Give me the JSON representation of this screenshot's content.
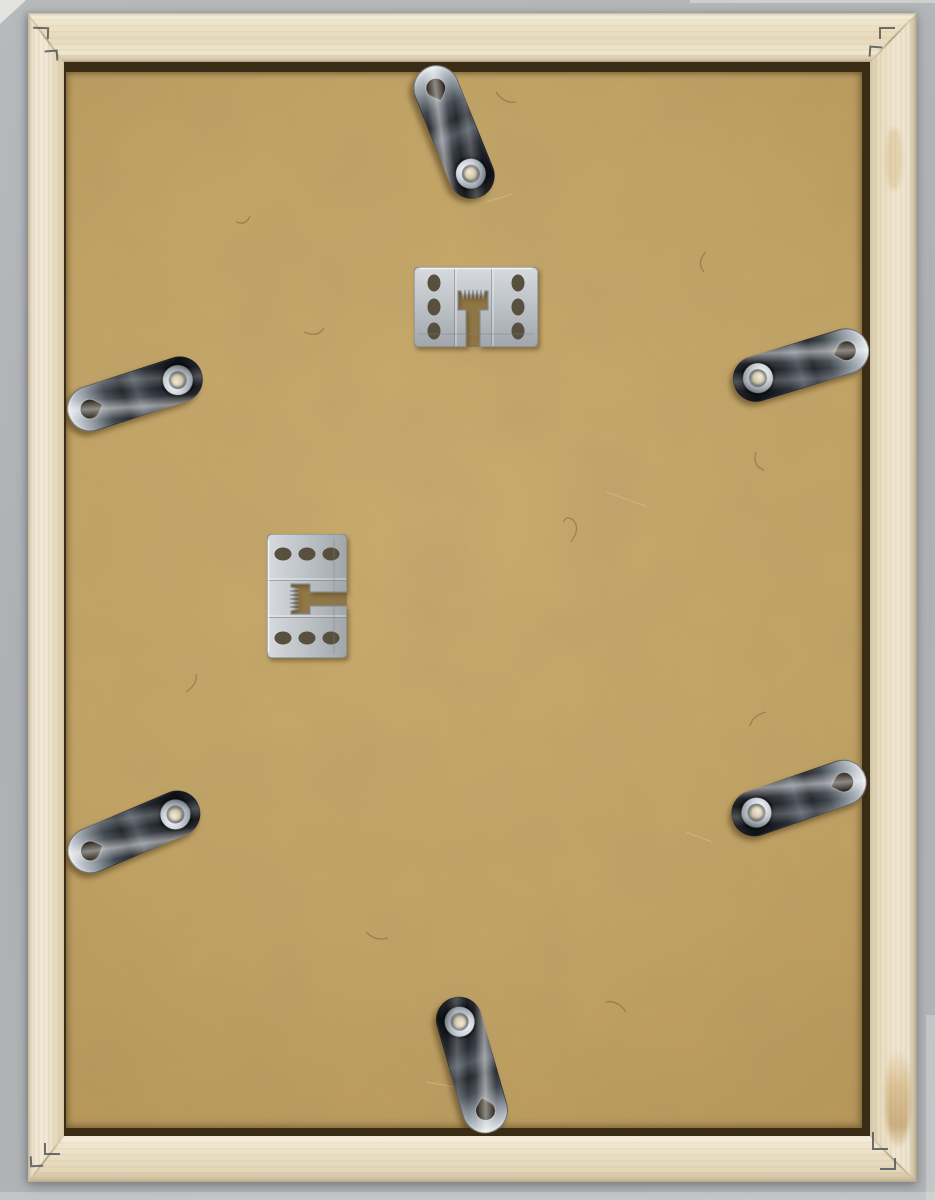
{
  "scene": {
    "type": "photograph",
    "subject": "Back side of an empty wooden picture frame lying on a gray surface",
    "background_surface": "plain light-gray textured backdrop",
    "frame": {
      "material": "natural pine wood",
      "corner_joinery": "mitered corners fastened with v-nails",
      "v_nail_marks_per_corner": 2,
      "glue_stain_location": "right rail near bottom corner"
    },
    "backing_board": {
      "material": "MDF hardboard",
      "color_hex": "#bfa162",
      "texture": "speckled fibers with light scratches"
    },
    "hardware": {
      "flexi_tabs": {
        "count": 6,
        "finish": "polished chrome steel",
        "features": [
          "teardrop keyhole at rim end",
          "screw with washer at inner end"
        ],
        "items": [
          {
            "id": "top-center",
            "x": 390,
            "y": 69.5,
            "rotation_deg": -22
          },
          {
            "id": "left-upper",
            "x": 70.5,
            "y": 331.5,
            "rotation_deg": -108
          },
          {
            "id": "right-upper",
            "x": 736.5,
            "y": 303,
            "rotation_deg": 73
          },
          {
            "id": "left-lower",
            "x": 70,
            "y": 769.5,
            "rotation_deg": -113
          },
          {
            "id": "right-lower",
            "x": 734.5,
            "y": 735.5,
            "rotation_deg": 71
          },
          {
            "id": "bottom-center",
            "x": 408,
            "y": 1003,
            "rotation_deg": 164
          }
        ]
      },
      "sawtooth_hangers": {
        "count": 2,
        "finish": "matte aluminum",
        "holes_per_hanger": 6,
        "teeth_per_hanger": 6,
        "items": [
          {
            "id": "upper",
            "x": 350,
            "y": 205,
            "rotation_deg": 0
          },
          {
            "id": "lower",
            "x": 180.5,
            "y": 494,
            "rotation_deg": -90
          }
        ]
      }
    },
    "palette": {
      "background_gray": "#b1b4b7",
      "wood_light": "#f0e8d4",
      "wood_mid": "#e8dcbe",
      "wood_shadow": "#c9bb9e",
      "recess_shadow": "#3a2c15",
      "mdf_tan": "#bfa162",
      "mdf_speck_dark": "#6d5526",
      "metal_bright": "#dfe3e7",
      "metal_dark": "#1a1e23",
      "aluminum": "#b9bec4",
      "glue_stain": "#b98434"
    }
  }
}
